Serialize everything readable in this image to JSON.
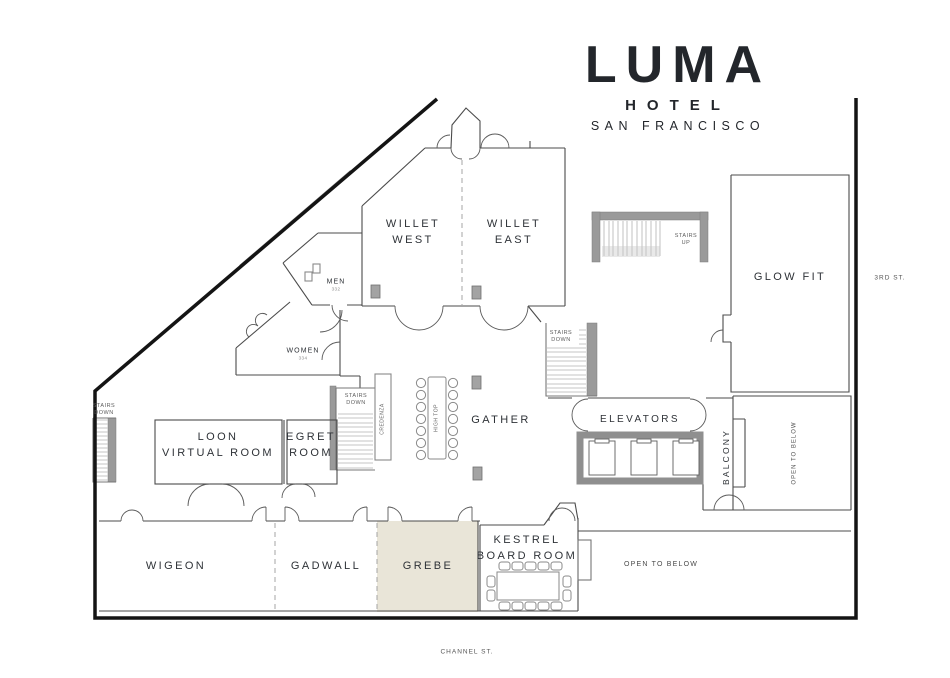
{
  "logo": {
    "name": "LUMA",
    "line2": "HOTEL",
    "line3": "SAN FRANCISCO"
  },
  "rooms": {
    "willet_west": {
      "line1": "WILLET",
      "line2": "WEST"
    },
    "willet_east": {
      "line1": "WILLET",
      "line2": "EAST"
    },
    "glow_fit": {
      "label": "GLOW FIT"
    },
    "men": {
      "label": "MEN",
      "number": "332"
    },
    "women": {
      "label": "WOMEN",
      "number": "334"
    },
    "loon": {
      "line1": "LOON",
      "line2": "VIRTUAL ROOM"
    },
    "egret": {
      "line1": "EGRET",
      "line2": "ROOM"
    },
    "gather": {
      "label": "GATHER"
    },
    "elevators": {
      "label": "ELEVATORS"
    },
    "balcony": {
      "label": "BALCONY"
    },
    "wigeon": {
      "label": "WIGEON"
    },
    "gadwall": {
      "label": "GADWALL"
    },
    "grebe": {
      "label": "GREBE"
    },
    "kestrel": {
      "line1": "KESTREL",
      "line2": "BOARD ROOM"
    }
  },
  "annotations": {
    "stairs_up": {
      "line1": "STAIRS",
      "line2": "UP"
    },
    "stairs_down": {
      "line1": "STAIRS",
      "line2": "DOWN"
    },
    "credenza": "CREDENZA",
    "high_top": "HIGH TOP",
    "open_to_below": "OPEN TO BELOW"
  },
  "streets": {
    "third": "3RD ST.",
    "channel": "CHANNEL ST."
  },
  "colors": {
    "grebe_highlight": "#e9e5d8",
    "wall": "#4b4b4b",
    "outline": "#141414",
    "stairs_gray": "#9a9a9a"
  }
}
